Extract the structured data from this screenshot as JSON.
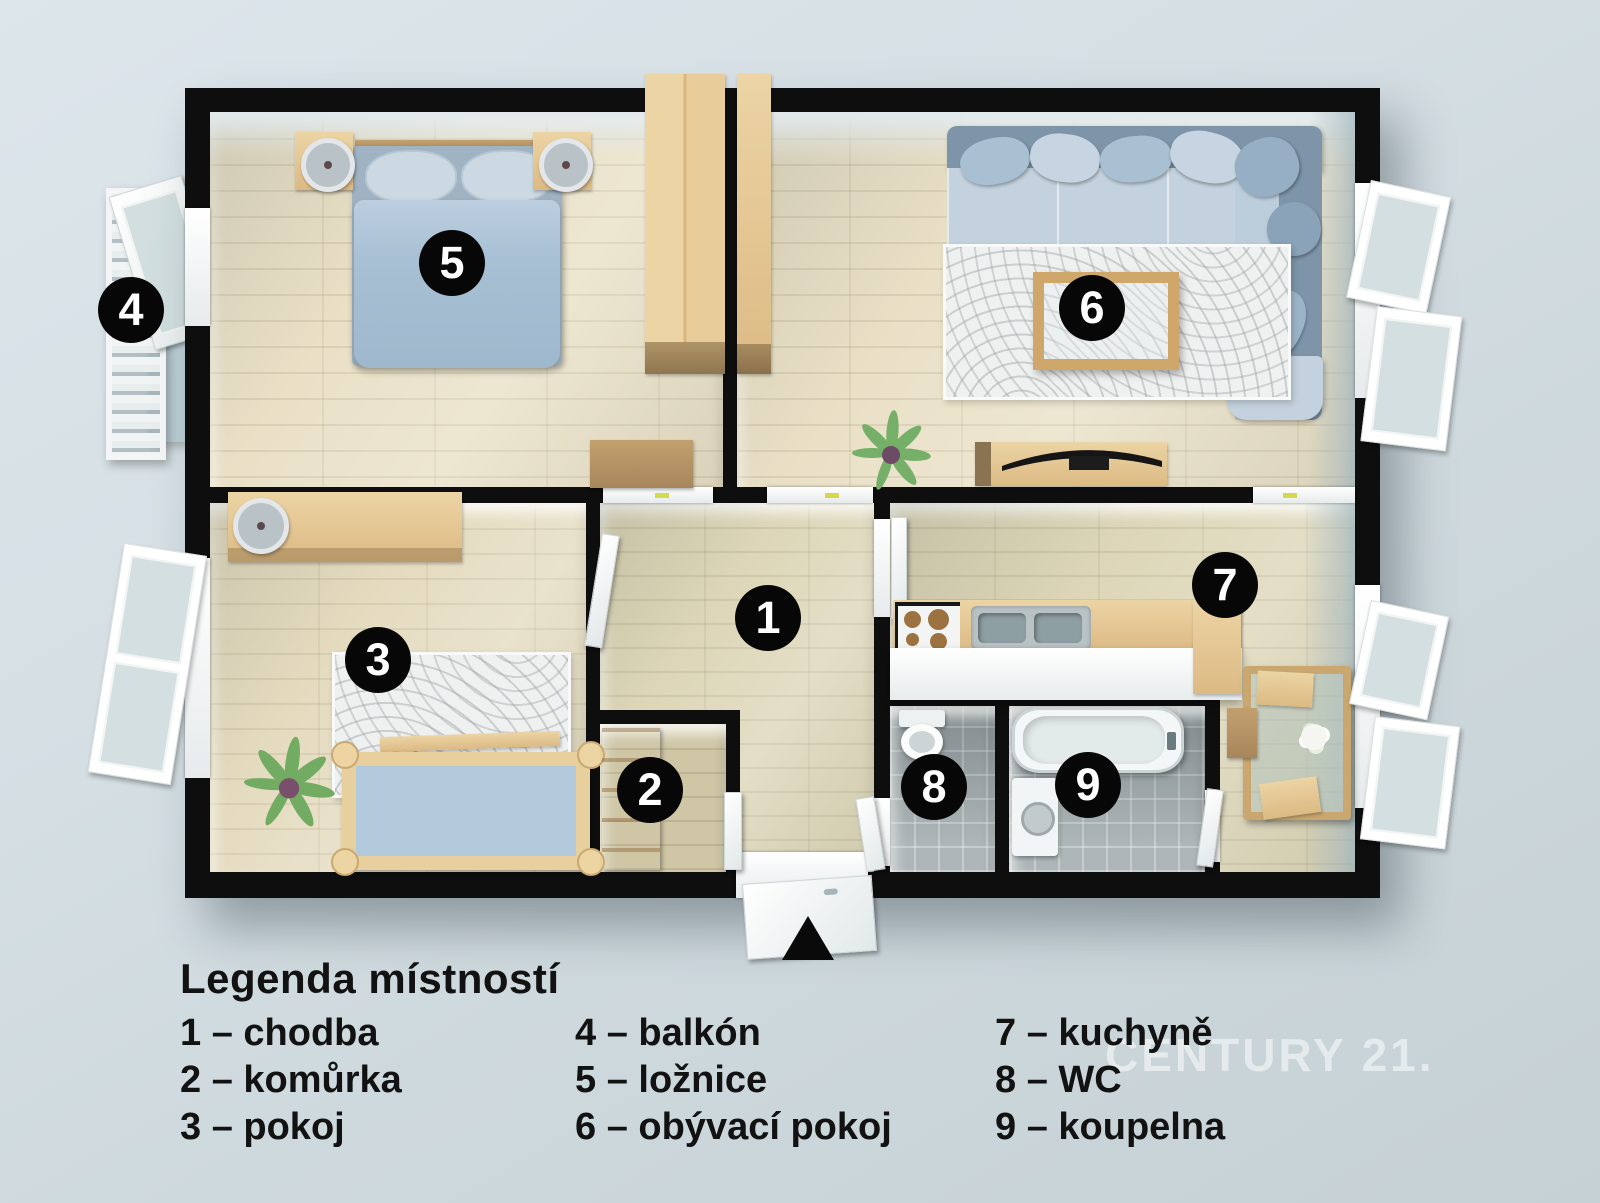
{
  "plan": {
    "badges": [
      {
        "num": "1"
      },
      {
        "num": "2"
      },
      {
        "num": "3"
      },
      {
        "num": "4"
      },
      {
        "num": "5"
      },
      {
        "num": "6"
      },
      {
        "num": "7"
      },
      {
        "num": "8"
      },
      {
        "num": "9"
      }
    ],
    "watermark": "CENTURY 21."
  },
  "legend": {
    "title": "Legenda místností",
    "columns": [
      {
        "items": [
          {
            "label": "1 – chodba"
          },
          {
            "label": "2 – komůrka"
          },
          {
            "label": "3 – pokoj"
          }
        ]
      },
      {
        "items": [
          {
            "label": "4 – balkón"
          },
          {
            "label": "5 – ložnice"
          },
          {
            "label": "6 – obývací pokoj"
          }
        ]
      },
      {
        "items": [
          {
            "label": "7 – kuchyně"
          },
          {
            "label": "8 – WC"
          },
          {
            "label": "9 – koupelna"
          }
        ]
      }
    ]
  },
  "colors": {
    "background": "#d3dde2",
    "wall": "#0e0e0e",
    "wood_floor": "#e9e0c6",
    "tile_floor": "#98a2a5",
    "furniture_wood": "#ddbb85",
    "sofa_seat": "#c3d2de",
    "sofa_back": "#7e95a9",
    "bed_duvet": "#a8c0d4",
    "rug": "#eff1f1",
    "badge_bg": "#070707",
    "badge_text": "#ffffff",
    "handle_yellow": "#d5d94e"
  }
}
